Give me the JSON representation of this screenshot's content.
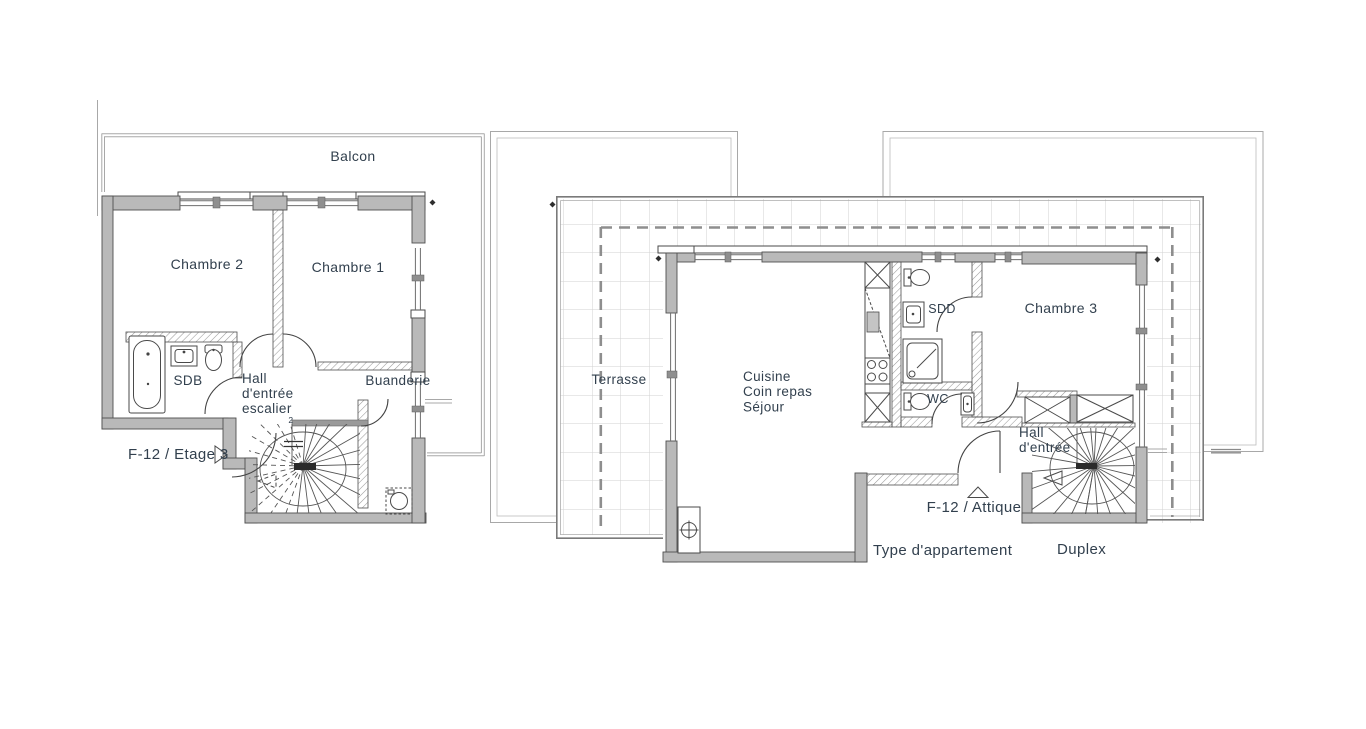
{
  "colors": {
    "text": "#32404e",
    "wall_fill": "#b9b9b9",
    "wall_stroke": "#4f4f4f",
    "hatch_wall": "#9a9a9a",
    "terrace_grid": "#d2d2d2",
    "terrace_boundary": "#7a7a7a",
    "property_dash": "#8e8e8e",
    "outline_thin": "#a8a8a8",
    "marker": "#2e2e2e"
  },
  "etage": {
    "label": "F-12 / Etage 3",
    "balcon": "Balcon",
    "chambre2": "Chambre 2",
    "chambre1": "Chambre 1",
    "sdb": "SDB",
    "hall_l1": "Hall",
    "hall_l2": "d'entrée",
    "hall_l3": "escalier",
    "buanderie": "Buanderie",
    "stair_mark": "2"
  },
  "attique": {
    "label": "F-12 / Attique",
    "terrasse": "Terrasse",
    "sejour_l1": "Cuisine",
    "sejour_l2": "Coin repas",
    "sejour_l3": "Séjour",
    "sdd": "SDD",
    "chambre3": "Chambre 3",
    "wc": "WC",
    "hall_l1": "Hall",
    "hall_l2": "d'entrée"
  },
  "footer": {
    "type_label": "Type d'appartement",
    "type_value": "Duplex"
  }
}
